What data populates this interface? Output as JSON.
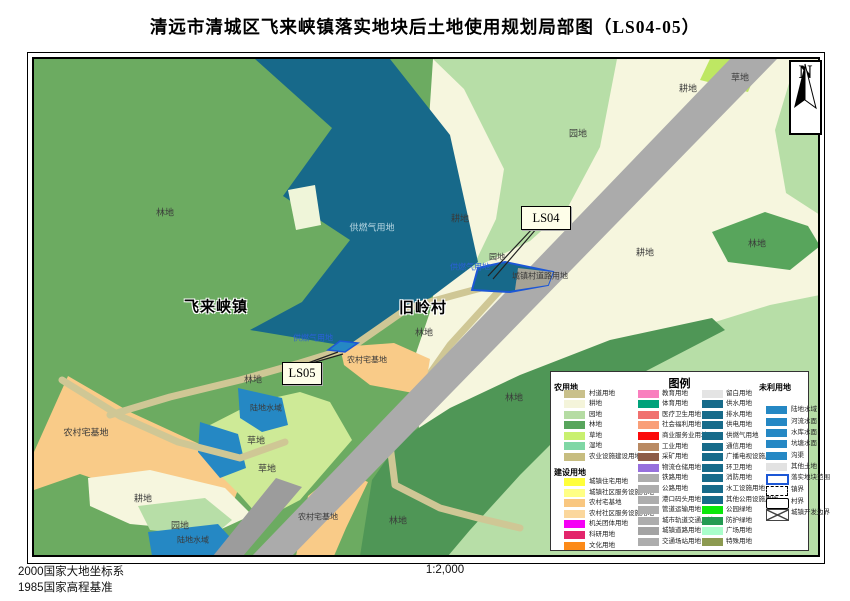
{
  "title": "清远市清城区飞来峡镇落实地块后土地使用规划局部图（LS04-05）",
  "north_label": "N",
  "footer": {
    "datum_line1": "2000国家大地坐标系",
    "datum_line2": "1985国家高程基准",
    "scale": "1:2,000"
  },
  "map": {
    "labels": [
      [
        "林地",
        131,
        153,
        "norm"
      ],
      [
        "供燃气用地",
        338,
        168,
        "light"
      ],
      [
        "耕地",
        654,
        29,
        "norm"
      ],
      [
        "草地",
        706,
        18,
        "norm"
      ],
      [
        "园地",
        544,
        74,
        "norm"
      ],
      [
        "耕地",
        426,
        159,
        "norm"
      ],
      [
        "园地",
        463,
        198,
        "small"
      ],
      [
        "供燃气用地",
        436,
        208,
        "blue"
      ],
      [
        "城镇村道路用地",
        506,
        217,
        "small"
      ],
      [
        "林地",
        723,
        184,
        "norm"
      ],
      [
        "耕地",
        611,
        193,
        "norm"
      ],
      [
        "飞来峡镇",
        182,
        247,
        "town"
      ],
      [
        "旧岭村",
        389,
        248,
        "town"
      ],
      [
        "林地",
        390,
        273,
        "norm"
      ],
      [
        "供燃气用地",
        279,
        279,
        "blue"
      ],
      [
        "农村宅基地",
        333,
        301,
        "small"
      ],
      [
        "林地",
        219,
        320,
        "norm"
      ],
      [
        "陆地水域",
        232,
        349,
        "small"
      ],
      [
        "农村宅基地",
        52,
        373,
        "norm"
      ],
      [
        "草地",
        222,
        381,
        "norm"
      ],
      [
        "草地",
        233,
        409,
        "norm"
      ],
      [
        "耕地",
        109,
        439,
        "norm"
      ],
      [
        "园地",
        146,
        466,
        "norm"
      ],
      [
        "陆地水域",
        159,
        481,
        "small"
      ],
      [
        "农村宅基地",
        284,
        458,
        "small"
      ],
      [
        "林地",
        364,
        461,
        "norm"
      ],
      [
        "林地",
        480,
        338,
        "norm"
      ]
    ],
    "callouts": [
      {
        "label": "LS04",
        "x": 487,
        "y": 147,
        "w": 48,
        "h": 22
      },
      {
        "label": "LS05",
        "x": 248,
        "y": 303,
        "w": 38,
        "h": 21
      }
    ]
  },
  "legend": {
    "title": "图例",
    "columns": [
      {
        "header_x": 3,
        "swatch_x": 13,
        "label_x": 38,
        "entries": [
          [
            "h",
            "农用地",
            null,
            10
          ],
          [
            "i",
            "村道用地",
            "#C9C08B",
            18
          ],
          [
            "i",
            "耕地",
            "#F4F4DA",
            28
          ],
          [
            "i",
            "园地",
            "#B5DCA3",
            38.5
          ],
          [
            "i",
            "林地",
            "#58A55C",
            49
          ],
          [
            "i",
            "草地",
            "#C9F06F",
            59.5
          ],
          [
            "i",
            "湿地",
            "#7FD7A5",
            70
          ],
          [
            "i",
            "农业设施建设用地",
            "#C7BD80",
            80.5
          ],
          [
            "h",
            "建设用地",
            null,
            95
          ],
          [
            "i",
            "城镇住宅用地",
            "#FFFF3A",
            106
          ],
          [
            "i",
            "城镇社区服务设施用地",
            "#FFFF85",
            116.6
          ],
          [
            "i",
            "农村宅基地",
            "#F9C780",
            127.2
          ],
          [
            "i",
            "农村社区服务设施用地",
            "#FBD79C",
            137.8
          ],
          [
            "i",
            "机关团体用地",
            "#F500F5",
            148.4
          ],
          [
            "i",
            "科研用地",
            "#E3256B",
            159
          ],
          [
            "i",
            "文化用地",
            "#FC8A18",
            169.6
          ]
        ]
      },
      {
        "header_x": 80,
        "swatch_x": 87,
        "label_x": 111,
        "entries": [
          [
            "i",
            "教育用地",
            "#F97FBE",
            17.5
          ],
          [
            "i",
            "体育用地",
            "#00A27A",
            28.1
          ],
          [
            "i",
            "医疗卫生用地",
            "#F0716F",
            38.7
          ],
          [
            "i",
            "社会福利用地",
            "#F99F79",
            49.3
          ],
          [
            "i",
            "商业服务业用地",
            "#FB0A0A",
            59.9
          ],
          [
            "i",
            "工业用地",
            "#B98A63",
            70.5
          ],
          [
            "i",
            "采矿用地",
            "#8D5B47",
            81.1
          ],
          [
            "i",
            "物流仓储用地",
            "#9770DD",
            91.7
          ],
          [
            "i",
            "铁路用地",
            "#ADADAD",
            102.3
          ],
          [
            "i",
            "公路用地",
            "#ADADAD",
            112.9
          ],
          [
            "i",
            "港口码头用地",
            "#ADADAD",
            123.5
          ],
          [
            "i",
            "管道运输用地",
            "#ADADAD",
            134.1
          ],
          [
            "i",
            "城市轨道交通用地",
            "#ADADAD",
            144.7
          ],
          [
            "i",
            "城镇道路用地",
            "#A3A3A3",
            155.3
          ],
          [
            "i",
            "交通场站用地",
            "#ADADAD",
            165.9
          ]
        ]
      },
      {
        "header_x": 145,
        "swatch_x": 151,
        "label_x": 175,
        "entries": [
          [
            "i",
            "留白用地",
            "#E4E4E4",
            17.5
          ],
          [
            "i",
            "供水用地",
            "#176B8A",
            28.1
          ],
          [
            "i",
            "排水用地",
            "#176B8A",
            38.7
          ],
          [
            "i",
            "供电用地",
            "#176B8A",
            49.3
          ],
          [
            "i",
            "供燃气用地",
            "#176B8A",
            59.9
          ],
          [
            "i",
            "通信用地",
            "#176B8A",
            70.5
          ],
          [
            "i",
            "广播电视设施用地",
            "#176B8A",
            81.1
          ],
          [
            "i",
            "环卫用地",
            "#176B8A",
            91.7
          ],
          [
            "i",
            "消防用地",
            "#176B8A",
            102.3
          ],
          [
            "i",
            "水工设施用地",
            "#176B8A",
            112.9
          ],
          [
            "i",
            "其他公用设施用地",
            "#176B8A",
            123.5
          ],
          [
            "i",
            "公园绿地",
            "#0AE80A",
            134.1
          ],
          [
            "i",
            "防护绿地",
            "#239B51",
            144.7
          ],
          [
            "i",
            "广场用地",
            "#A9FECA",
            155.3
          ],
          [
            "i",
            "特殊用地",
            "#8C9A50",
            165.9
          ]
        ]
      },
      {
        "header_x": 208,
        "swatch_x": 215,
        "label_x": 240,
        "entries": [
          [
            "h",
            "未利用地",
            null,
            10
          ],
          [
            "i",
            "陆地水域",
            "#2588C4",
            34
          ],
          [
            "i",
            "河流水面",
            "#2588C4",
            46
          ],
          [
            "i",
            "水库水面",
            "#2588C4",
            57
          ],
          [
            "i",
            "坑塘水面",
            "#2588C4",
            68
          ],
          [
            "i",
            "沟渠",
            "#2588C4",
            80
          ],
          [
            "i",
            "其他土地",
            "#E2E2E2",
            91
          ],
          [
            "ob",
            "落实地块范围",
            null,
            102
          ],
          [
            "od",
            "镇界",
            null,
            114
          ],
          [
            "os",
            "村界",
            null,
            126
          ],
          [
            "ox",
            "城镇开发边界",
            null,
            137
          ]
        ]
      }
    ]
  },
  "colors": {
    "forest": "#6CAB61",
    "orchard": "#B7DEA7",
    "cropland": "#F6F6DE",
    "grass_bright": "#BEE763",
    "grass_light": "#CEEA97",
    "gas_supply_teal": "#17698A",
    "water": "#2588C4",
    "homestead_peach": "#F9CB88",
    "village_road_tan": "#CFC795",
    "highway_gray": "#ABABAB",
    "parcel_outline_blue": "#1C57D6"
  }
}
